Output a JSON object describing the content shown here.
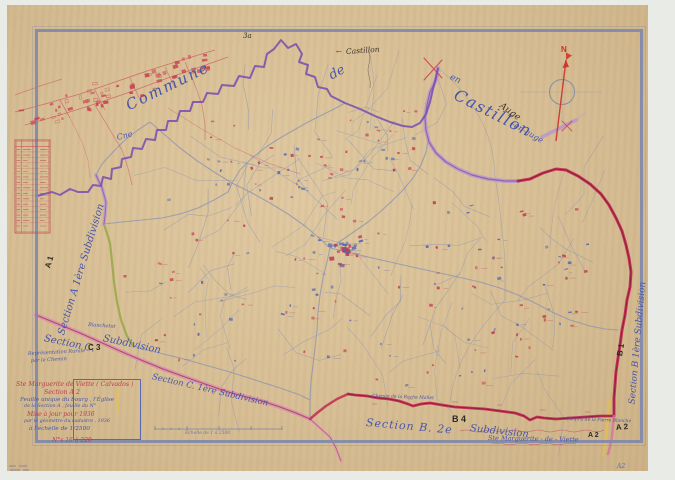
{
  "labels": {
    "commune": "Commune",
    "de": "de",
    "en": "en",
    "castillon_large": "Castillon",
    "en_auge": "-en-auge",
    "castillon_small": "Castillon",
    "arrow": "←",
    "auge": "Auge",
    "mark_3a": "3a",
    "cne": "Cne",
    "north": "N"
  },
  "sections": {
    "a_script": "Section A 1ère Subdivision",
    "a_stamp": "A 1",
    "c_script1": "Section C.",
    "c_stamp": "C 3",
    "c_script2": "Subdivision",
    "c_lower": "Section C. 1ère Subdivision",
    "b_script1": "Section B. 2e",
    "b_stamp": "B 4",
    "b_script2": "Subdivision",
    "b_right_script": "Section B 1ère Subdivision",
    "b_right_stamp": "B 1",
    "a2_stamp": "A 2",
    "a2_margin": "A2"
  },
  "cartouche": {
    "line1": "Ste Marguerite de Viette ( Calvados )",
    "line2": "Section A 2",
    "line3": "Feuille unique du bourg , l'Église",
    "line4": "de la Section A , feuille du N°",
    "line5": "Mise à jour pour 1936",
    "line6": "par le géomètre du cadastre , 1936",
    "line7": "à l'échelle de 1/2500",
    "line8": "N°s 16 à 220"
  },
  "notes": {
    "representation1": "Représentation Rurale",
    "representation2": "par le Chemin",
    "ste_marguerite": "Ste Marguerite - de - Viette",
    "ste_marguerite_stamp": "A 2",
    "blanchetot": "Blanchetot",
    "chemin": "Chemin de la Roche Mallet",
    "confins": "Confins de la Pierre Blanche",
    "scale_caption": "Échelle de 1 à 2500"
  },
  "colors": {
    "paper": "#d8bf95",
    "frame": "#7e88ac",
    "boundary_purple": "#7a50b0",
    "road_crimson": "#c22a52",
    "road_lilac": "#b695cc",
    "road_pink": "#dc8fae",
    "road_green": "#9aa84a",
    "road_yellow": "#e2c04a",
    "ink_blue": "#4656aa",
    "ink_red": "#c23a4a",
    "ink_black": "#3a332b"
  }
}
